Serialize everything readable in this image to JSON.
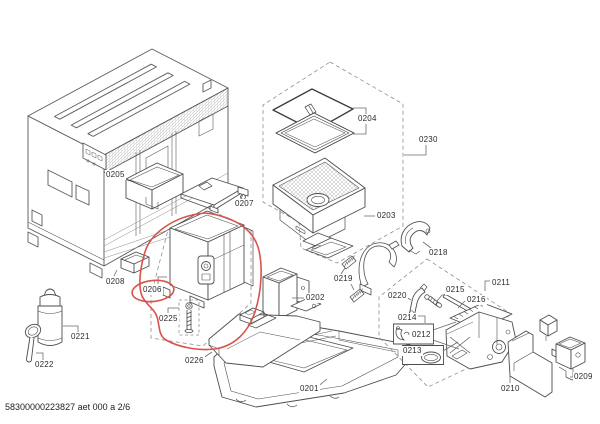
{
  "doc": {
    "footer_text": "58300000223827 aet 000 a 2/6"
  },
  "diagram": {
    "type": "exploded-parts-diagram",
    "colors": {
      "line": "#4d4d4d",
      "dashed_region": "#8f8f8f",
      "highlight": "#d9534a",
      "background": "#ffffff",
      "label_text": "#2a2a2a"
    },
    "highlight": {
      "part": "0206",
      "style": "hand-drawn-ellipse"
    },
    "labels": [
      {
        "text": "0201"
      },
      {
        "text": "0202"
      },
      {
        "text": "0203"
      },
      {
        "text": "0204"
      },
      {
        "text": "0205"
      },
      {
        "text": "0206"
      },
      {
        "text": "0207"
      },
      {
        "text": "0208"
      },
      {
        "text": "0209"
      },
      {
        "text": "0210"
      },
      {
        "text": "0211"
      },
      {
        "text": "0212"
      },
      {
        "text": "0213"
      },
      {
        "text": "0214"
      },
      {
        "text": "0215"
      },
      {
        "text": "0216"
      },
      {
        "text": "0218"
      },
      {
        "text": "0219"
      },
      {
        "text": "0220"
      },
      {
        "text": "0221"
      },
      {
        "text": "0222"
      },
      {
        "text": "0225"
      },
      {
        "text": "0226"
      },
      {
        "text": "0230"
      }
    ]
  }
}
